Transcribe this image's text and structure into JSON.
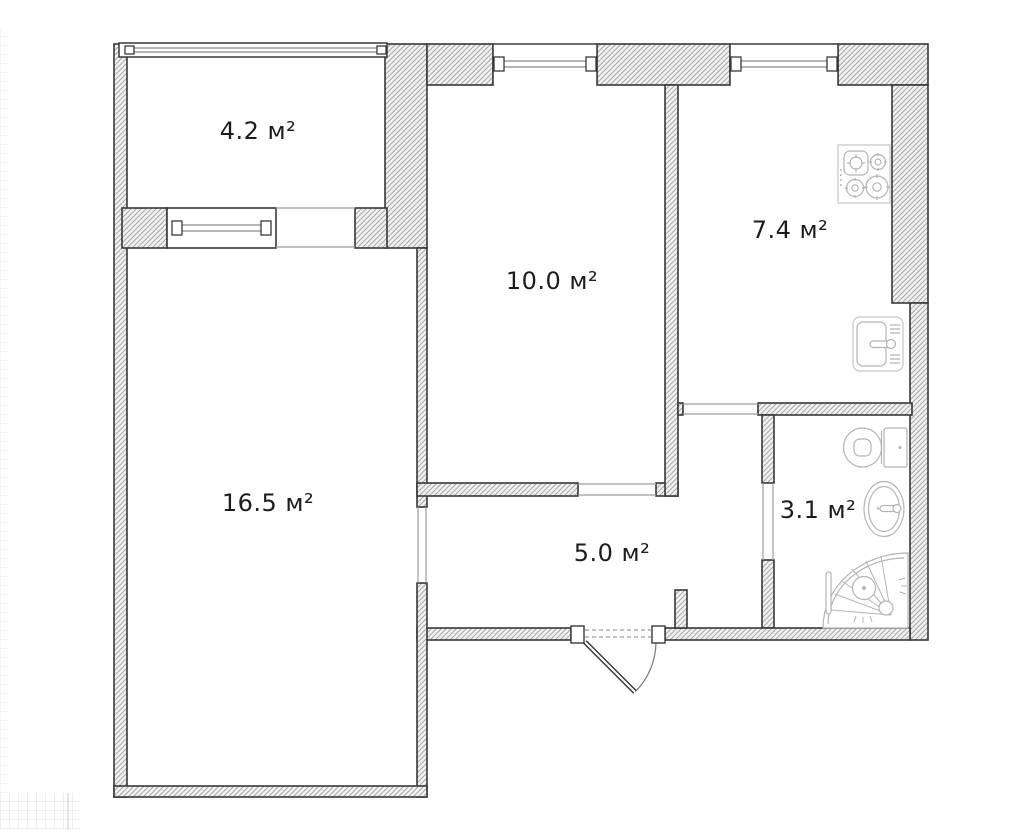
{
  "floor_plan": {
    "unit_suffix": "м²",
    "rooms": [
      {
        "name": "balcony",
        "area_label": "4.2 м²"
      },
      {
        "name": "bedroom",
        "area_label": "10.0 м²"
      },
      {
        "name": "kitchen",
        "area_label": "7.4 м²"
      },
      {
        "name": "living-room",
        "area_label": "16.5 м²"
      },
      {
        "name": "hallway",
        "area_label": "5.0 м²"
      },
      {
        "name": "bathroom",
        "area_label": "3.1 м²"
      }
    ],
    "fixtures": [
      "gas-stove",
      "kitchen-sink",
      "toilet",
      "washbasin",
      "shower-cabin",
      "entrance-door"
    ],
    "colors": {
      "background": "#ffffff",
      "wall_fill": "#f1f1f1",
      "wall_hatch_line": "#a9a9a9",
      "wall_outline": "#383838",
      "opening_line": "#9c9c9c",
      "fixture_stroke": "#b4b4b4",
      "label_text": "#1c1c1c",
      "grid_line": "#dcdcdc"
    }
  }
}
